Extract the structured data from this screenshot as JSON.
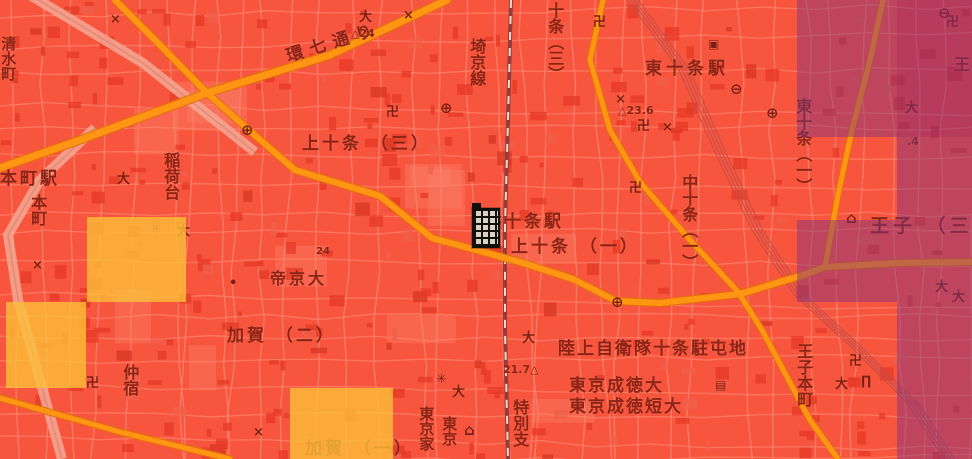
{
  "map": {
    "colors": {
      "background_red": "#f7553e",
      "street": "#ff8168",
      "building": "#e63a27",
      "main_road_orange": "#ff9613",
      "road_casing": "#e07109",
      "rail_line": "#933c3c",
      "label_text": "#8a2416",
      "heat_dark_tile": "rgba(128,52,128,0.48)",
      "heat_dark_extra": "rgba(150,20,90,0.16)",
      "heat_yellow_tile": "rgba(251,191,56,0.8)"
    },
    "labels": [
      {
        "id": "shimizucho",
        "text": "清水町",
        "dir": "v",
        "x": 0,
        "y": 36,
        "size": 15
      },
      {
        "id": "honcho-station",
        "text": "本町駅",
        "dir": "h",
        "x": 0,
        "y": 170,
        "size": 17,
        "spacing": 3
      },
      {
        "id": "honcho",
        "text": "本町",
        "dir": "v",
        "x": 29,
        "y": 194,
        "size": 16
      },
      {
        "id": "inaridai",
        "text": "稲荷台",
        "dir": "v",
        "x": 162,
        "y": 152,
        "size": 16
      },
      {
        "id": "kannana-dori",
        "text": "環七通り",
        "dir": "r",
        "x": 287,
        "y": 48,
        "size": 17,
        "spacing": 7,
        "rot": -17
      },
      {
        "id": "elev-24",
        "text": "△24",
        "dir": "h",
        "x": 351,
        "y": 28,
        "size": 11,
        "elev": true
      },
      {
        "id": "kamijujo-3",
        "text": "上十条 （三）",
        "dir": "h",
        "x": 302,
        "y": 135,
        "size": 17,
        "spacing": 3
      },
      {
        "id": "saikyo-line",
        "text": "埼京線",
        "dir": "v",
        "x": 468,
        "y": 38,
        "size": 16
      },
      {
        "id": "jujo-3",
        "text": "十条（三）",
        "dir": "v",
        "x": 546,
        "y": 2,
        "size": 16
      },
      {
        "id": "higashi-jujo-station",
        "text": "東十条駅",
        "dir": "h",
        "x": 645,
        "y": 60,
        "size": 17,
        "spacing": 4
      },
      {
        "id": "elev-23-6",
        "text": "△23.6",
        "dir": "h",
        "x": 618,
        "y": 105,
        "size": 11,
        "elev": true
      },
      {
        "id": "higashi-jujo-1",
        "text": "東十条（一）",
        "dir": "v",
        "x": 794,
        "y": 98,
        "size": 16
      },
      {
        "id": "oji-partial",
        "text": "王",
        "dir": "h",
        "x": 954,
        "y": 56,
        "size": 16
      },
      {
        "id": "jujo-station",
        "text": "十条駅",
        "dir": "h",
        "x": 504,
        "y": 213,
        "size": 17,
        "spacing": 3
      },
      {
        "id": "kamijujo-1",
        "text": "上十条 （一）",
        "dir": "h",
        "x": 511,
        "y": 238,
        "size": 17,
        "spacing": 3
      },
      {
        "id": "naka-jujo-1",
        "text": "中十条（一）",
        "dir": "v",
        "x": 680,
        "y": 174,
        "size": 16
      },
      {
        "id": "oji-3",
        "text": "王子 （三）",
        "dir": "h",
        "x": 870,
        "y": 216,
        "size": 19,
        "spacing": 4
      },
      {
        "id": "teikyo-univ",
        "text": "帝京大",
        "dir": "h",
        "x": 270,
        "y": 270,
        "size": 16,
        "spacing": 3
      },
      {
        "id": "kaga-2",
        "text": "加賀 （二）",
        "dir": "h",
        "x": 227,
        "y": 327,
        "size": 17,
        "spacing": 3
      },
      {
        "id": "kaga-1",
        "text": "加賀 （一）",
        "dir": "h",
        "x": 305,
        "y": 440,
        "size": 17,
        "spacing": 3
      },
      {
        "id": "nakajuku",
        "text": "仲宿",
        "dir": "v",
        "x": 121,
        "y": 364,
        "size": 16
      },
      {
        "id": "elev-21-7",
        "text": "21.7△",
        "dir": "h",
        "x": 503,
        "y": 364,
        "size": 11,
        "elev": true
      },
      {
        "id": "jsdf-jujo-camp",
        "text": "陸上自衛隊十条駐屯地",
        "dir": "h",
        "x": 558,
        "y": 340,
        "size": 17,
        "spacing": 2
      },
      {
        "id": "tokyo-seitoku-univ",
        "text": "東京成徳大",
        "dir": "h",
        "x": 569,
        "y": 377,
        "size": 17,
        "spacing": 2
      },
      {
        "id": "tokyo-seitoku-jc",
        "text": "東京成徳短大",
        "dir": "h",
        "x": 569,
        "y": 398,
        "size": 17,
        "spacing": 2
      },
      {
        "id": "tokubetsu-shi",
        "text": "特別支",
        "dir": "v",
        "x": 511,
        "y": 399,
        "size": 16
      },
      {
        "id": "tokyo-ka",
        "text": "東京家",
        "dir": "v",
        "x": 418,
        "y": 406,
        "size": 15
      },
      {
        "id": "tokyo-partial",
        "text": "東京",
        "dir": "v",
        "x": 441,
        "y": 416,
        "size": 15
      },
      {
        "id": "oji-honcho",
        "text": "王子本町",
        "dir": "v",
        "x": 795,
        "y": 343,
        "size": 16
      },
      {
        "id": "elev-4",
        "text": ".4",
        "dir": "h",
        "x": 907,
        "y": 136,
        "size": 11,
        "elev": true
      },
      {
        "id": "elev-24b",
        "text": "24",
        "dir": "h",
        "x": 316,
        "y": 247,
        "size": 10,
        "elev": true
      }
    ],
    "symbols": [
      {
        "type": "swastika-temple-icon",
        "x": 593,
        "y": 16
      },
      {
        "type": "swastika-temple-icon",
        "x": 946,
        "y": 16
      },
      {
        "type": "swastika-temple-icon",
        "x": 386,
        "y": 106
      },
      {
        "type": "swastika-temple-icon",
        "x": 637,
        "y": 120
      },
      {
        "type": "swastika-temple-icon",
        "x": 629,
        "y": 182
      },
      {
        "type": "swastika-temple-icon",
        "x": 849,
        "y": 355
      },
      {
        "type": "swastika-temple-icon",
        "x": 86,
        "y": 377
      },
      {
        "type": "police-x-icon",
        "x": 403,
        "y": 9
      },
      {
        "type": "police-x-icon",
        "x": 110,
        "y": 13
      },
      {
        "type": "police-x-icon",
        "x": 492,
        "y": 214
      },
      {
        "type": "police-x-icon",
        "x": 615,
        "y": 93
      },
      {
        "type": "police-x-icon",
        "x": 662,
        "y": 121
      },
      {
        "type": "police-x-icon",
        "x": 32,
        "y": 259
      },
      {
        "type": "police-x-icon",
        "x": 253,
        "y": 426
      },
      {
        "type": "university-icon",
        "x": 359,
        "y": 11
      },
      {
        "type": "university-icon",
        "x": 522,
        "y": 332
      },
      {
        "type": "university-icon",
        "x": 452,
        "y": 386
      },
      {
        "type": "university-icon",
        "x": 905,
        "y": 102
      },
      {
        "type": "university-icon",
        "x": 935,
        "y": 281
      },
      {
        "type": "university-icon",
        "x": 952,
        "y": 291
      },
      {
        "type": "university-icon",
        "x": 177,
        "y": 225
      },
      {
        "type": "university-icon",
        "x": 117,
        "y": 173
      },
      {
        "type": "university-icon",
        "x": 835,
        "y": 378
      },
      {
        "type": "post-office-icon",
        "x": 440,
        "y": 101
      },
      {
        "type": "post-office-icon",
        "x": 766,
        "y": 106
      },
      {
        "type": "post-office-icon",
        "x": 241,
        "y": 123
      },
      {
        "type": "post-office-icon",
        "x": 611,
        "y": 295
      },
      {
        "type": "station-icon",
        "x": 730,
        "y": 82
      },
      {
        "type": "station-icon",
        "x": 938,
        "y": 6
      },
      {
        "type": "government-office-icon",
        "x": 151,
        "y": 223
      },
      {
        "type": "government-office-icon",
        "x": 436,
        "y": 373
      },
      {
        "type": "museum-icon",
        "x": 846,
        "y": 211
      },
      {
        "type": "museum-icon",
        "x": 464,
        "y": 423
      },
      {
        "type": "hospital-icon",
        "x": 229,
        "y": 277
      },
      {
        "type": "library-icon",
        "x": 715,
        "y": 379
      },
      {
        "type": "facility-icon",
        "x": 708,
        "y": 38
      },
      {
        "type": "gate-icon",
        "x": 861,
        "y": 375
      }
    ],
    "heat_tiles": [
      {
        "x": 797,
        "y": 0,
        "w": 175,
        "h": 137,
        "level": "dark"
      },
      {
        "x": 897,
        "y": 0,
        "w": 75,
        "h": 137,
        "level": "dark-extra"
      },
      {
        "x": 897,
        "y": 137,
        "w": 75,
        "h": 83,
        "level": "dark"
      },
      {
        "x": 797,
        "y": 220,
        "w": 175,
        "h": 82,
        "level": "dark"
      },
      {
        "x": 897,
        "y": 302,
        "w": 75,
        "h": 157,
        "level": "dark"
      },
      {
        "x": 87,
        "y": 217,
        "w": 99,
        "h": 85,
        "level": "yellow"
      },
      {
        "x": 6,
        "y": 302,
        "w": 80,
        "h": 86,
        "level": "yellow"
      },
      {
        "x": 290,
        "y": 388,
        "w": 103,
        "h": 71,
        "level": "yellow"
      }
    ],
    "roads": [
      {
        "id": "kannana-dori-road",
        "w": 7,
        "pts": [
          [
            0,
            168
          ],
          [
            80,
            140
          ],
          [
            207,
            93
          ],
          [
            330,
            55
          ],
          [
            447,
            0
          ]
        ]
      },
      {
        "id": "jujo-main-road",
        "w": 6,
        "pts": [
          [
            115,
            0
          ],
          [
            160,
            45
          ],
          [
            207,
            93
          ],
          [
            250,
            131
          ],
          [
            295,
            170
          ],
          [
            380,
            196
          ],
          [
            432,
            238
          ],
          [
            520,
            262
          ],
          [
            573,
            279
          ],
          [
            616,
            301
          ],
          [
            660,
            303
          ],
          [
            740,
            294
          ],
          [
            800,
            276
          ],
          [
            825,
            267
          ],
          [
            900,
            263
          ],
          [
            972,
            262
          ]
        ]
      },
      {
        "id": "oji-south-branch",
        "w": 5,
        "pts": [
          [
            740,
            295
          ],
          [
            762,
            330
          ],
          [
            786,
            375
          ],
          [
            810,
            420
          ],
          [
            838,
            459
          ]
        ]
      },
      {
        "id": "naka-jujo-road",
        "w": 5,
        "pts": [
          [
            603,
            0
          ],
          [
            590,
            60
          ],
          [
            610,
            130
          ],
          [
            640,
            182
          ],
          [
            690,
            240
          ],
          [
            727,
            280
          ],
          [
            740,
            294
          ]
        ]
      },
      {
        "id": "east-vertical-road",
        "w": 5,
        "pts": [
          [
            883,
            0
          ],
          [
            870,
            60
          ],
          [
            852,
            130
          ],
          [
            838,
            195
          ],
          [
            825,
            267
          ]
        ]
      },
      {
        "id": "southwest-road",
        "w": 5,
        "pts": [
          [
            0,
            398
          ],
          [
            60,
            415
          ],
          [
            120,
            432
          ],
          [
            230,
            459
          ]
        ]
      }
    ],
    "railways": [
      {
        "id": "saikyo-rail",
        "pts": [
          [
            511,
            0
          ],
          [
            508,
            120
          ],
          [
            505,
            225
          ],
          [
            505,
            330
          ],
          [
            508,
            459
          ]
        ]
      }
    ],
    "rail_corridor": {
      "id": "keihin-tohoku-yard",
      "pts": [
        [
          630,
          -5
        ],
        [
          685,
          70
        ],
        [
          720,
          150
        ],
        [
          758,
          230
        ],
        [
          800,
          295
        ],
        [
          855,
          345
        ],
        [
          915,
          405
        ],
        [
          950,
          459
        ]
      ]
    },
    "pale_bands": [
      {
        "id": "shinkansen-band-ne",
        "pts": [
          [
            30,
            -5
          ],
          [
            143,
            63
          ],
          [
            255,
            152
          ]
        ]
      },
      {
        "id": "shinkansen-band-sw",
        "pts": [
          [
            95,
            128
          ],
          [
            40,
            180
          ],
          [
            8,
            235
          ],
          [
            18,
            300
          ],
          [
            40,
            380
          ],
          [
            62,
            459
          ]
        ]
      }
    ],
    "marker": {
      "id": "building-marker",
      "x": 472,
      "y": 208,
      "w": 24,
      "h": 36
    }
  }
}
